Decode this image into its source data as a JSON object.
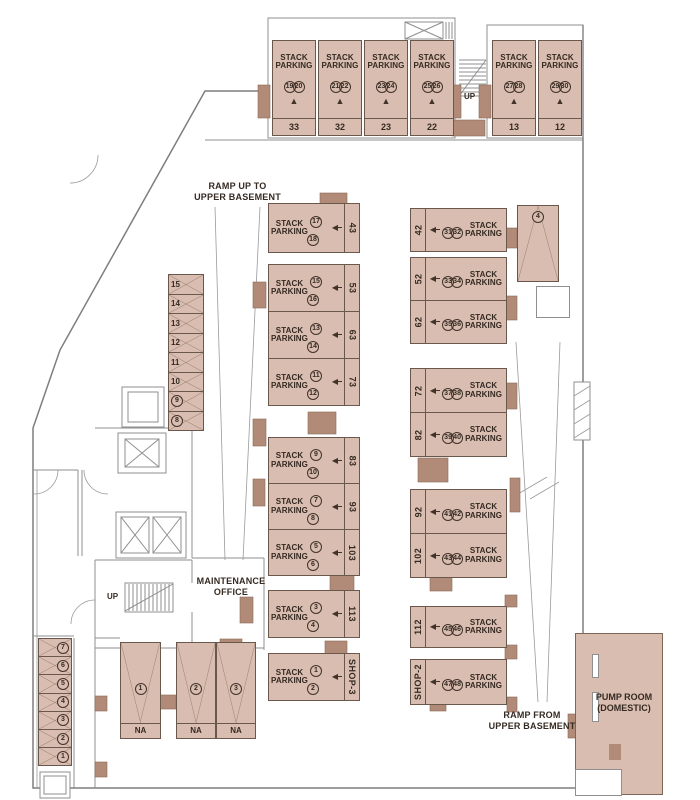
{
  "colors": {
    "stall_fill": "#d9bdb0",
    "stall_line": "#6b584c",
    "column": "#b18b77",
    "wall": "#8f8f8f",
    "text": "#352a23"
  },
  "labels": {
    "stack_line1": "STACK",
    "stack_line2": "PARKING",
    "ramp_up_line1": "RAMP UP TO",
    "ramp_up_line2": "UPPER BASEMENT",
    "ramp_from_line1": "RAMP FROM",
    "ramp_from_line2": "UPPER BASEMENT",
    "maintenance_line1": "MAINTENANCE",
    "maintenance_line2": "OFFICE",
    "pump_line1": "PUMP ROOM",
    "pump_line2": "(DOMESTIC)",
    "up_top": "UP",
    "up_mid": "UP",
    "na": "NA",
    "arrow_up": "▲",
    "arrow_left": "◀"
  },
  "stalls": {
    "top_left": [
      {
        "a": "19",
        "b": "20",
        "bay": "33"
      },
      {
        "a": "21",
        "b": "22",
        "bay": "32"
      },
      {
        "a": "23",
        "b": "24",
        "bay": "23"
      },
      {
        "a": "25",
        "b": "26",
        "bay": "22"
      }
    ],
    "top_right": [
      {
        "a": "27",
        "b": "28",
        "bay": "13"
      },
      {
        "a": "29",
        "b": "30",
        "bay": "12"
      }
    ],
    "mid_a": [
      {
        "a": "17",
        "b": "18",
        "bay": "43"
      }
    ],
    "mid_b": [
      {
        "a": "15",
        "b": "16",
        "bay": "53"
      },
      {
        "a": "13",
        "b": "14",
        "bay": "63"
      },
      {
        "a": "11",
        "b": "12",
        "bay": "73"
      }
    ],
    "mid_c": [
      {
        "a": "9",
        "b": "10",
        "bay": "83"
      },
      {
        "a": "7",
        "b": "8",
        "bay": "93"
      },
      {
        "a": "5",
        "b": "6",
        "bay": "103"
      }
    ],
    "mid_d": [
      {
        "a": "3",
        "b": "4",
        "bay": "113"
      }
    ],
    "mid_e": [
      {
        "a": "1",
        "b": "2",
        "bay": "SHOP-3"
      }
    ],
    "right_a": [
      {
        "a": "31",
        "b": "32",
        "bay": "42"
      }
    ],
    "right_b": [
      {
        "a": "33",
        "b": "34",
        "bay": "52"
      },
      {
        "a": "35",
        "b": "36",
        "bay": "62"
      }
    ],
    "right_c": [
      {
        "a": "37",
        "b": "38",
        "bay": "72"
      },
      {
        "a": "39",
        "b": "40",
        "bay": "82"
      }
    ],
    "right_d": [
      {
        "a": "41",
        "b": "42",
        "bay": "92"
      },
      {
        "a": "43",
        "b": "44",
        "bay": "102"
      }
    ],
    "right_e": [
      {
        "a": "45",
        "b": "46",
        "bay": "112"
      }
    ],
    "right_f": [
      {
        "a": "47",
        "b": "48",
        "bay": "SHOP-2"
      }
    ]
  },
  "bike_left": [
    {
      "n": "15",
      "circ": false
    },
    {
      "n": "14",
      "circ": false
    },
    {
      "n": "13",
      "circ": false
    },
    {
      "n": "12",
      "circ": false
    },
    {
      "n": "11",
      "circ": false
    },
    {
      "n": "10",
      "circ": false
    },
    {
      "n": "9",
      "circ": true
    },
    {
      "n": "8",
      "circ": true
    }
  ],
  "bike_bottom": [
    {
      "n": "7",
      "circ": true
    },
    {
      "n": "6",
      "circ": true
    },
    {
      "n": "5",
      "circ": true
    },
    {
      "n": "4",
      "circ": true
    },
    {
      "n": "3",
      "circ": true
    },
    {
      "n": "2",
      "circ": true
    },
    {
      "n": "1",
      "circ": true
    }
  ],
  "na_a": [
    {
      "n": "1"
    }
  ],
  "na_b": [
    {
      "n": "2"
    },
    {
      "n": "3"
    }
  ],
  "ramp_stall": {
    "n": "4"
  }
}
